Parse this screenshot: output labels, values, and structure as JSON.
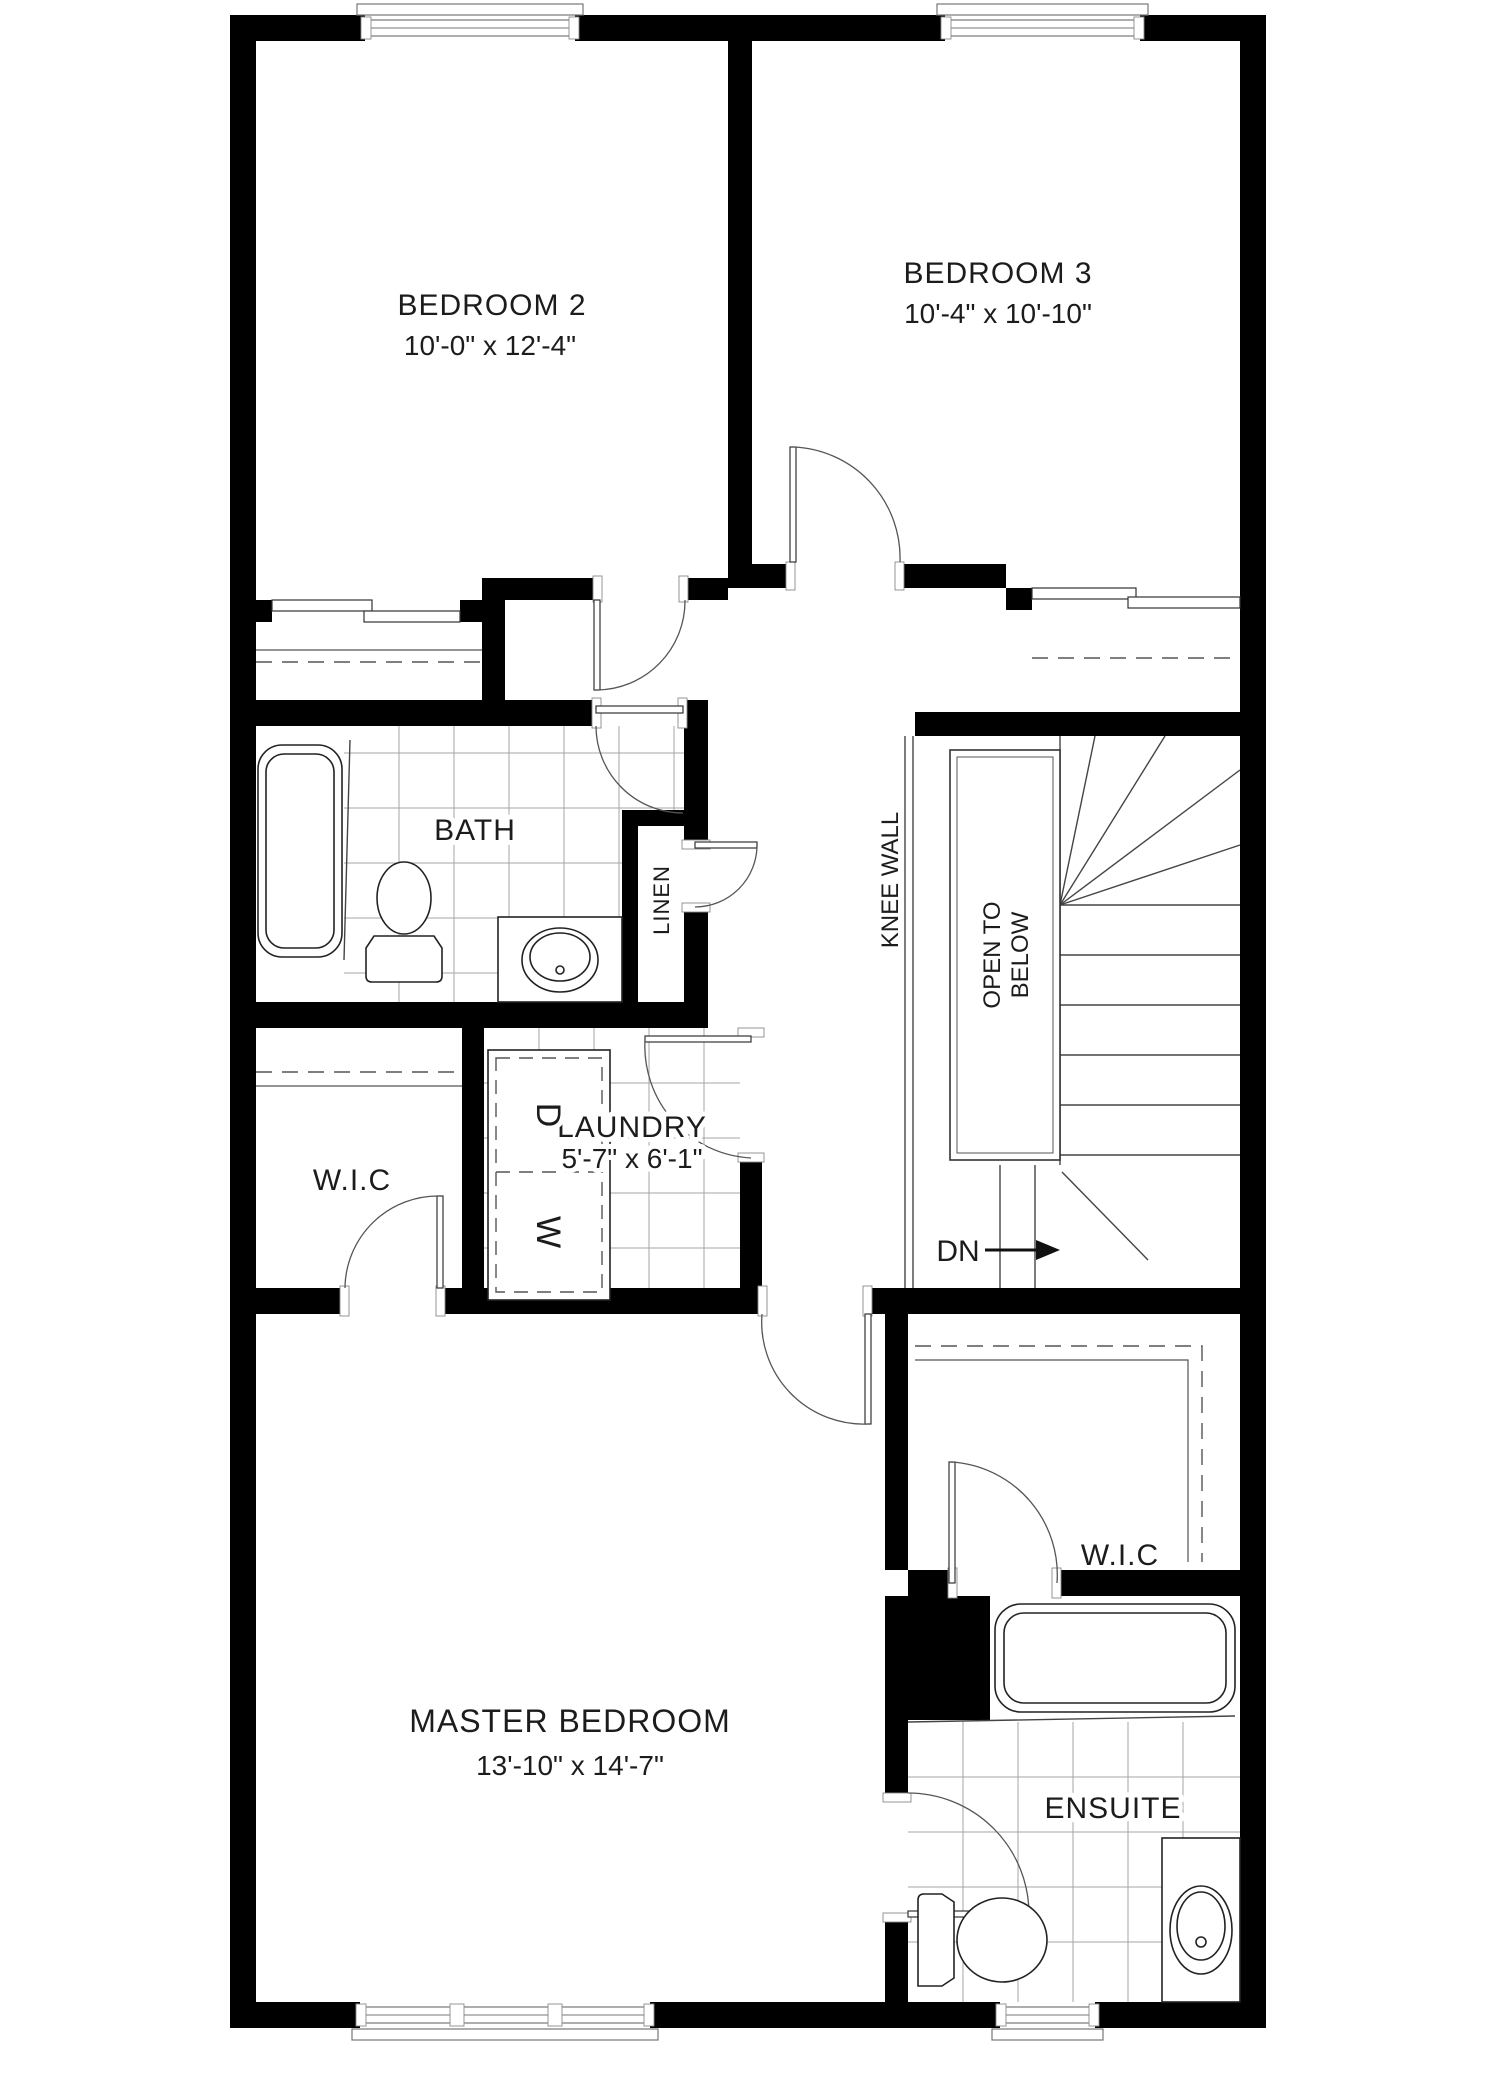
{
  "title": "Upper floor plan",
  "rooms": {
    "bedroom2": {
      "label": "BEDROOM  2",
      "dims": "10'-0\" x 12'-4\""
    },
    "bedroom3": {
      "label": "BEDROOM 3",
      "dims": "10'-4\" x 10'-10\""
    },
    "bath": {
      "label": "BATH"
    },
    "linen": {
      "label": "LINEN"
    },
    "laundry": {
      "label": "LAUNDRY",
      "dims": "5'-7\" x 6'-1\""
    },
    "wic_left": {
      "label": "W.I.C"
    },
    "wic_right": {
      "label": "W.I.C"
    },
    "master": {
      "label": "MASTER BEDROOM",
      "dims": "13'-10\" x 14'-7\""
    },
    "ensuite": {
      "label": "ENSUITE"
    }
  },
  "annotations": {
    "knee_wall": {
      "label": "KNEE WALL"
    },
    "open_to_below": {
      "line1": "OPEN TO",
      "line2": "BELOW"
    },
    "down": {
      "label": "DN"
    },
    "dryer": {
      "label": "D"
    },
    "washer": {
      "label": "W"
    }
  },
  "colors": {
    "wall": "#000000",
    "line": "#444444",
    "tile": "#a6a6a6",
    "background": "#ffffff"
  }
}
